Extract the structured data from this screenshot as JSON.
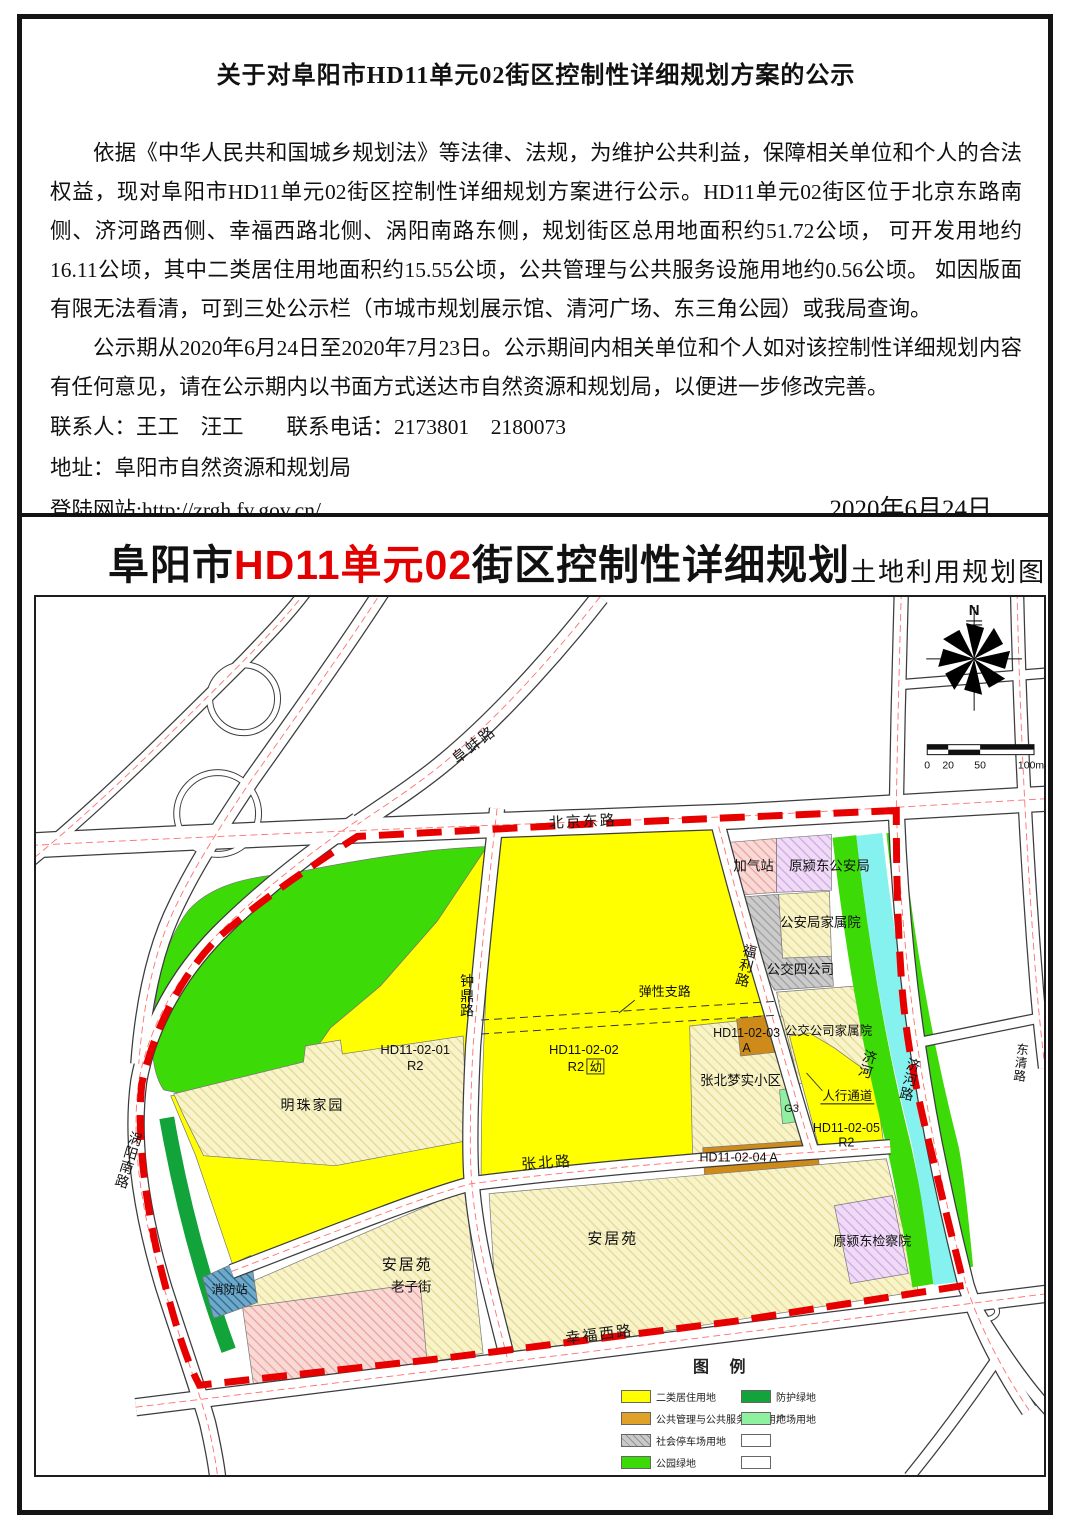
{
  "notice": {
    "title": "关于对阜阳市HD11单元02街区控制性详细规划方案的公示",
    "paragraph1": "依据《中华人民共和国城乡规划法》等法律、法规，为维护公共利益，保障相关单位和个人的合法权益，现对阜阳市HD11单元02街区控制性详细规划方案进行公示。HD11单元02街区位于北京东路南侧、济河路西侧、幸福西路北侧、涡阳南路东侧，规划街区总用地面积约51.72公顷， 可开发用地约16.11公顷，其中二类居住用地面积约15.55公顷，公共管理与公共服务设施用地约0.56公顷。 如因版面有限无法看清，可到三处公示栏（市城市规划展示馆、清河广场、东三角公园）或我局查询。",
    "paragraph2": "公示期从2020年6月24日至2020年7月23日。公示期间内相关单位和个人如对该控制性详细规划内容有任何意见，请在公示期内以书面方式送达市自然资源和规划局，以便进一步修改完善。",
    "contact_line": "联系人：王工　汪工　　联系电话：2173801　2180073",
    "address_line": "地址：阜阳市自然资源和规划局",
    "website_line": "登陆网站:http://zrgh.fy.gov.cn/",
    "date": "2020年6月24日"
  },
  "map": {
    "title_prefix": "阜阳市",
    "title_highlight": "HD11单元02",
    "title_suffix": "街区控制性详细规划",
    "subtitle": "土地利用规划图",
    "north_label": "N",
    "scale": {
      "t0": "0",
      "t20": "20",
      "t50": "50",
      "t100": "100m"
    },
    "labels": {
      "roads": {
        "fubeng": "阜蚌路",
        "beijing_east": "北京东路",
        "zhongding": "钟鼎路",
        "fuli": "福利路",
        "zhangbei": "张北路",
        "xingfu_west": "幸福西路",
        "woyang_south": "涡阳南路",
        "jihe": "济河路",
        "dongqing": "东清路",
        "elastic": "弹性支路"
      },
      "water": {
        "jihe_river": "济河"
      },
      "zones": {
        "z01_code": "HD11-02-01",
        "z01_use": "R2",
        "z02_code": "HD11-02-02",
        "z02_use": "R2",
        "z02_kg": "幼",
        "z03_code": "HD11-02-03",
        "z03_use": "A",
        "z04_code": "HD11-02-04 A",
        "z05_code": "HD11-02-05",
        "z05_use": "R2",
        "g3": "G3"
      },
      "places": {
        "mingzhu": "明珠家园",
        "gas_station": "加气站",
        "former_police": "原颍东公安局",
        "police_family": "公安局家属院",
        "bus_company": "公交四公司",
        "bus_family": "公交公司家属院",
        "zhangbei_mengshi": "张北梦实小区",
        "pedestrian": "人行通道",
        "anju_left": "安居苑",
        "anju_right": "安居苑",
        "procuratorate": "原颍东检察院",
        "fire_station": "消防站",
        "laozi_street": "老子街"
      }
    },
    "legend": {
      "title": "图 例",
      "items": [
        {
          "label": "二类居住用地",
          "color": "#ffff00"
        },
        {
          "label": "公共管理与公共服务设施用地",
          "color": "#dfa128"
        },
        {
          "label": "社会停车场用地",
          "color": "#c9c9c9"
        },
        {
          "label": "公园绿地",
          "color": "#3cdb07"
        },
        {
          "label": "防护绿地",
          "color": "#12a43b"
        },
        {
          "label": "广场用地",
          "color": "#8ff0a0"
        },
        {
          "label": "",
          "color": "#ffffff"
        },
        {
          "label": "",
          "color": "#ffffff"
        }
      ]
    }
  },
  "colors": {
    "boundary_red": "#e60000",
    "title_red": "#e50000",
    "residential_yellow": "#ffff00",
    "public_facility_brown": "#cf8b1a",
    "park_green": "#3cdb07",
    "protective_green": "#12a43b",
    "plaza_green": "#8ff0a0",
    "river_cyan": "#86f2ef",
    "parking_gray": "#c9c9c9",
    "existing_cream": "#f8f3c8",
    "fire_station_blue": "#6ea9c9",
    "gas_station_pink": "#f9d9d6",
    "retained_lavender": "#f0dbf7"
  }
}
